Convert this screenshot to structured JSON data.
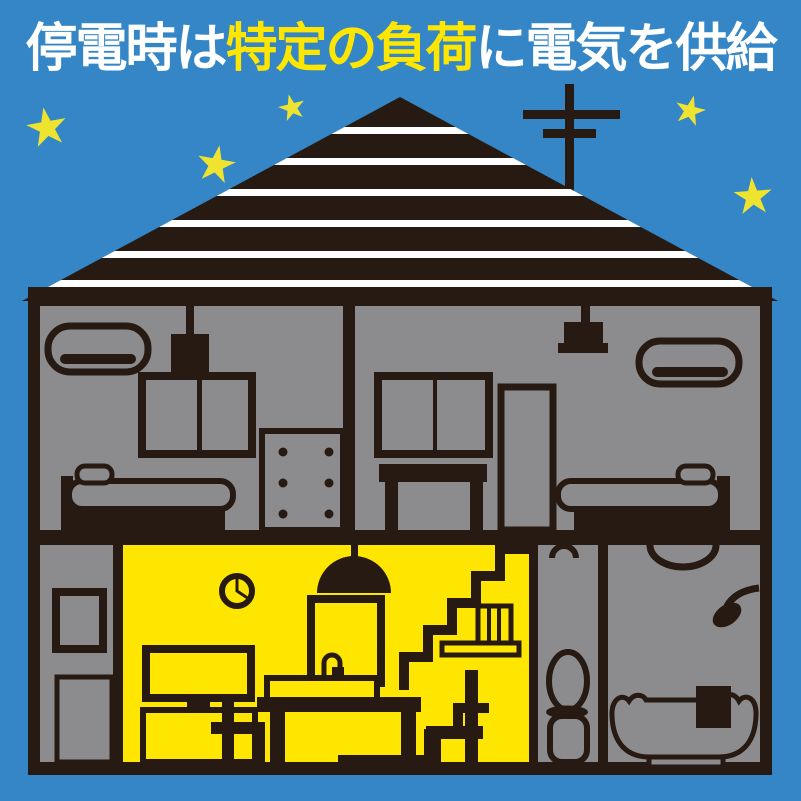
{
  "title": {
    "part1": "停電時は",
    "part2": "特定の負荷",
    "part3": "に電気を供給"
  },
  "colors": {
    "sky": "#3486c6",
    "ink": "#261a12",
    "room-gray": "#8c8c8e",
    "power-yellow": "#ffe600",
    "star-yellow": "#eee42f",
    "white": "#ffffff"
  },
  "scene": {
    "star_count": 5,
    "powered_room": "living-dining-kitchen",
    "rooms_without_power": [
      "bedroom-left",
      "bedroom-right",
      "entrance-hall",
      "toilet-room",
      "bathroom"
    ]
  }
}
